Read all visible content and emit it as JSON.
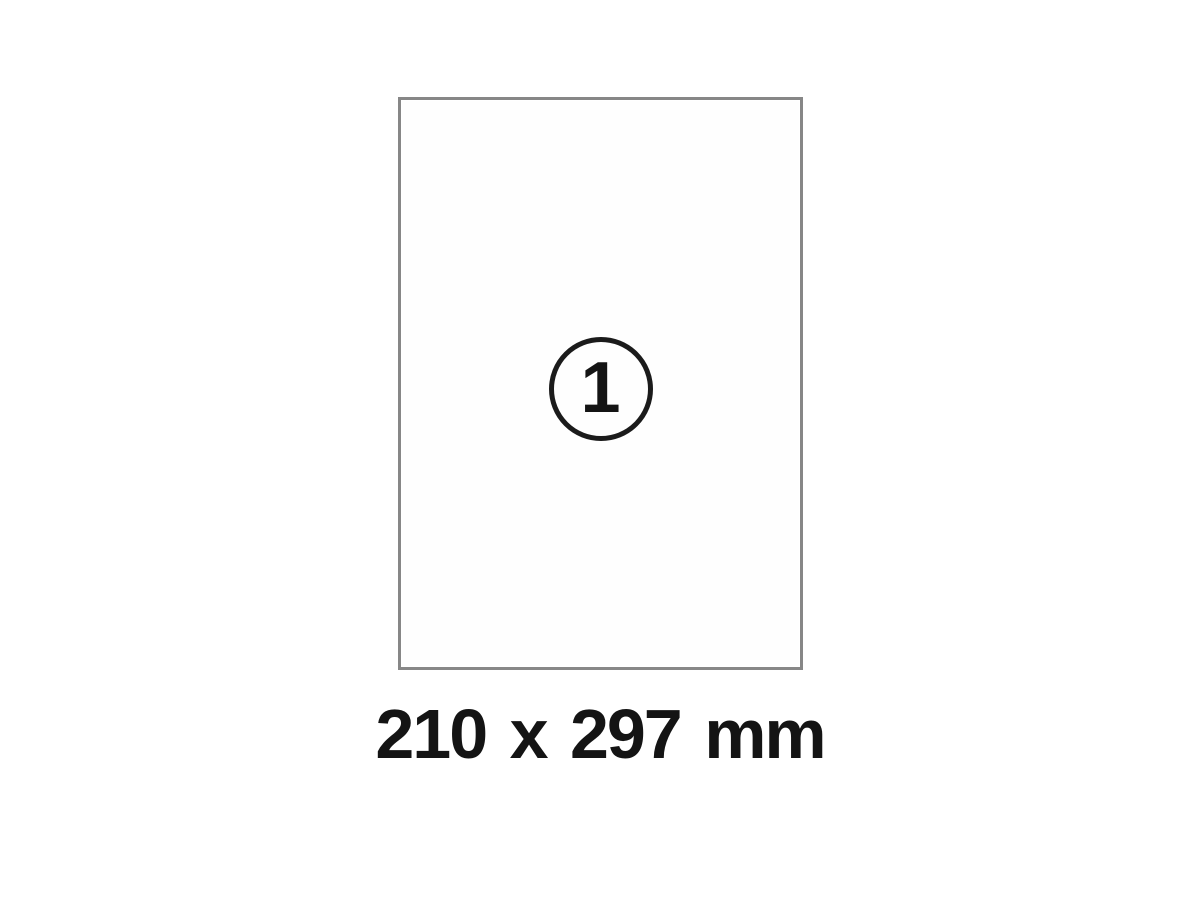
{
  "diagram": {
    "badge_number": "1",
    "dimensions_label": "210 x 297 mm"
  },
  "colors": {
    "background": "#ffffff",
    "sheet_fill": "#fefefe",
    "sheet_border": "#878787",
    "badge_border": "#1b1b1b",
    "text": "#141414"
  }
}
